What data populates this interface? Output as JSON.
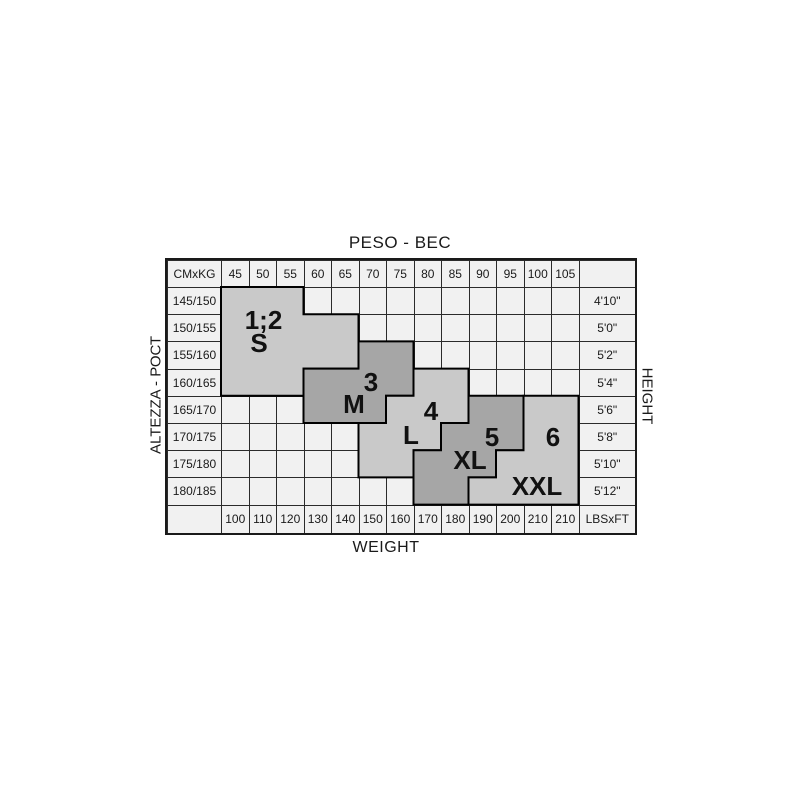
{
  "chart_data": {
    "type": "table",
    "title": "PESO - ВЕС",
    "xlabel_bottom": "WEIGHT",
    "ylabel_left": "ALTEZZA - РОСТ",
    "ylabel_right": "HEIGHT",
    "corner_label": "CMxKG",
    "footer_corner_label": "LBSxFT",
    "kg_columns": [
      "45",
      "50",
      "55",
      "60",
      "65",
      "70",
      "75",
      "80",
      "85",
      "90",
      "95",
      "100",
      "105"
    ],
    "lbs_columns": [
      "100",
      "110",
      "120",
      "130",
      "140",
      "150",
      "160",
      "170",
      "180",
      "190",
      "200",
      "210",
      "210"
    ],
    "cm_rows": [
      "145/150",
      "150/155",
      "155/160",
      "160/165",
      "165/170",
      "170/175",
      "175/180",
      "180/185"
    ],
    "ft_rows": [
      "4'10\"",
      "5'0\"",
      "5'2\"",
      "5'4\"",
      "5'6\"",
      "5'8\"",
      "5'10\"",
      "5'12\""
    ],
    "sizes": [
      {
        "id": "s",
        "number": "1;2",
        "letter": "S",
        "shade": "light",
        "cells": [
          {
            "row": 0,
            "from": 0,
            "to": 2
          },
          {
            "row": 1,
            "from": 0,
            "to": 4
          },
          {
            "row": 2,
            "from": 0,
            "to": 4
          },
          {
            "row": 3,
            "from": 0,
            "to": 2
          }
        ]
      },
      {
        "id": "m",
        "number": "3",
        "letter": "M",
        "shade": "dark",
        "cells": [
          {
            "row": 2,
            "from": 5,
            "to": 6
          },
          {
            "row": 3,
            "from": 3,
            "to": 6
          },
          {
            "row": 4,
            "from": 3,
            "to": 5
          }
        ]
      },
      {
        "id": "l",
        "number": "4",
        "letter": "L",
        "shade": "light",
        "cells": [
          {
            "row": 3,
            "from": 7,
            "to": 8
          },
          {
            "row": 4,
            "from": 6,
            "to": 8
          },
          {
            "row": 5,
            "from": 5,
            "to": 7
          },
          {
            "row": 6,
            "from": 5,
            "to": 6
          }
        ]
      },
      {
        "id": "xl",
        "number": "5",
        "letter": "XL",
        "shade": "dark",
        "cells": [
          {
            "row": 4,
            "from": 9,
            "to": 10
          },
          {
            "row": 5,
            "from": 8,
            "to": 10
          },
          {
            "row": 6,
            "from": 7,
            "to": 9
          },
          {
            "row": 7,
            "from": 7,
            "to": 8
          }
        ]
      },
      {
        "id": "xxl",
        "number": "6",
        "letter": "XXL",
        "shade": "light",
        "cells": [
          {
            "row": 4,
            "from": 11,
            "to": 12
          },
          {
            "row": 5,
            "from": 11,
            "to": 12
          },
          {
            "row": 6,
            "from": 10,
            "to": 12
          },
          {
            "row": 7,
            "from": 9,
            "to": 12
          }
        ]
      }
    ]
  },
  "colors": {
    "region_light": "#c9c9c9",
    "region_dark": "#a6a6a6",
    "cell_bg": "#f1f1f1",
    "grid_line": "#2b2b2b",
    "region_outline": "#000000",
    "text": "#1a1a1a"
  }
}
